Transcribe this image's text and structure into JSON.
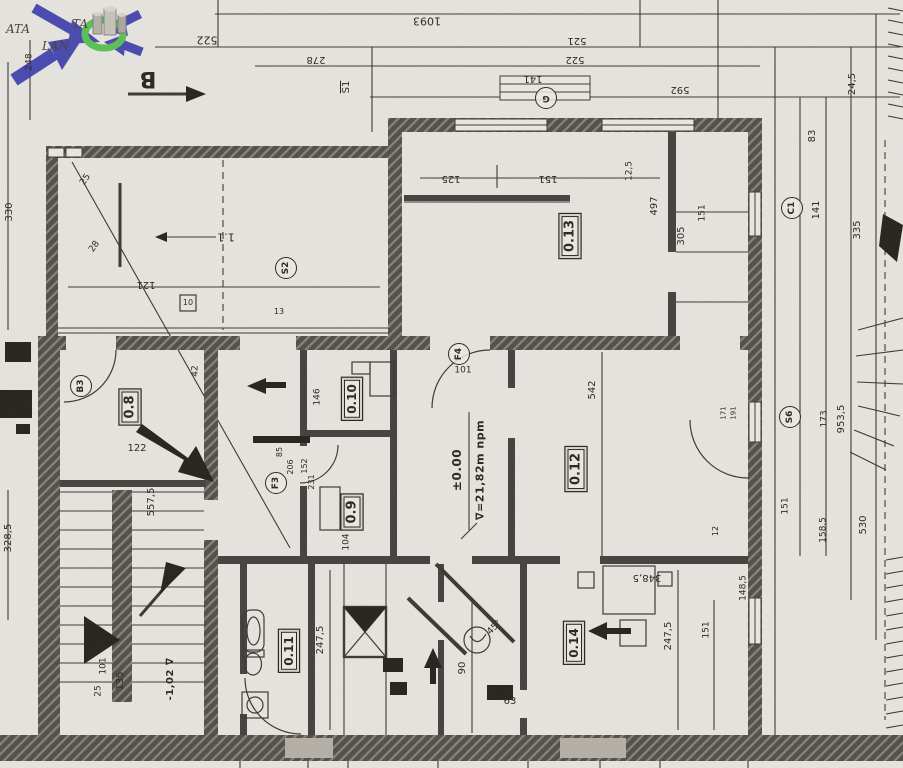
{
  "document": {
    "type": "scanned-floor-plan",
    "sheet": "ground-floor"
  },
  "colors": {
    "paper": "#e9e7e2",
    "ink": "#3c3934",
    "wall": "#514d47",
    "watermark_arrow": "#3d3dae",
    "watermark_ring": "#4fc14a"
  },
  "watermark": {
    "text_ata": "ATA",
    "text_ta": "TA",
    "text_lan": "LAN"
  },
  "levels": {
    "zero": "±0.00",
    "sea": "∇=21,82m npm",
    "minus": "-1,02 ∇"
  },
  "rooms": [
    "0.8",
    "0.9",
    "0.10",
    "0.11",
    "0.12",
    "0.13",
    "0.14",
    "1.1"
  ],
  "annotations": [
    {
      "n": "dim-1093",
      "t": "1093",
      "x": 427,
      "y": 21,
      "r": 180,
      "fs": 11
    },
    {
      "n": "dim-522-left",
      "t": "522",
      "x": 207,
      "y": 40,
      "r": 180,
      "fs": 11
    },
    {
      "n": "dim-278",
      "t": "278",
      "x": 316,
      "y": 59,
      "r": 180,
      "fs": 10
    },
    {
      "n": "dim-521",
      "t": "521",
      "x": 577,
      "y": 40,
      "r": 180,
      "fs": 10
    },
    {
      "n": "dim-522-mid",
      "t": "522",
      "x": 575,
      "y": 59,
      "r": 180,
      "fs": 10
    },
    {
      "n": "dim-141-top",
      "t": "141",
      "x": 533,
      "y": 78,
      "r": 180,
      "fs": 10
    },
    {
      "n": "dim-592",
      "t": "592",
      "x": 680,
      "y": 89,
      "r": 180,
      "fs": 10
    },
    {
      "n": "section-marker-b",
      "t": "B",
      "x": 148,
      "y": 78,
      "r": 180,
      "fs": 22,
      "cls": "sec"
    },
    {
      "n": "stair-label-s1",
      "t": "S1",
      "x": 347,
      "y": 87,
      "r": -90,
      "fs": 10,
      "cls": "ovl"
    },
    {
      "n": "dim-248",
      "t": "248",
      "x": 30,
      "y": 62,
      "r": -90,
      "fs": 9
    },
    {
      "n": "dim-330",
      "t": "330",
      "x": 10,
      "y": 212,
      "r": -90,
      "fs": 10
    },
    {
      "n": "dim-24-5",
      "t": "24,5",
      "x": 853,
      "y": 84,
      "r": -90,
      "fs": 10
    },
    {
      "n": "dim-83",
      "t": "83",
      "x": 813,
      "y": 136,
      "r": -90,
      "fs": 10
    },
    {
      "n": "dim-141-right",
      "t": "141",
      "x": 817,
      "y": 210,
      "r": -90,
      "fs": 10
    },
    {
      "n": "dim-335",
      "t": "335",
      "x": 858,
      "y": 230,
      "r": -90,
      "fs": 10
    },
    {
      "n": "dim-12-5",
      "t": "12,5",
      "x": 630,
      "y": 171,
      "r": -90,
      "fs": 9
    },
    {
      "n": "dim-125",
      "t": "125",
      "x": 451,
      "y": 178,
      "r": 180,
      "fs": 10
    },
    {
      "n": "dim-151-top",
      "t": "151",
      "x": 548,
      "y": 178,
      "r": 180,
      "fs": 10
    },
    {
      "n": "dim-497",
      "t": "497",
      "x": 655,
      "y": 206,
      "r": -90,
      "fs": 10
    },
    {
      "n": "dim-305",
      "t": "305",
      "x": 682,
      "y": 236,
      "r": -90,
      "fs": 10
    },
    {
      "n": "dim-151-corridor",
      "t": "151",
      "x": 703,
      "y": 213,
      "r": -90,
      "fs": 9
    },
    {
      "n": "room-label-0-13",
      "t": "0.13",
      "x": 570,
      "y": 236,
      "r": -90,
      "fs": 13,
      "cls": "box"
    },
    {
      "n": "label-1-1",
      "t": "1.1",
      "x": 226,
      "y": 237,
      "r": 180,
      "fs": 11
    },
    {
      "n": "dim-121",
      "t": "121",
      "x": 146,
      "y": 284,
      "r": 180,
      "fs": 10
    },
    {
      "n": "dim-25-terrace",
      "t": "25",
      "x": 86,
      "y": 180,
      "r": -55,
      "fs": 9
    },
    {
      "n": "dim-28-terrace",
      "t": "28",
      "x": 95,
      "y": 247,
      "r": -55,
      "fs": 9
    },
    {
      "n": "marker-s2",
      "t": "S2",
      "x": 286,
      "y": 268,
      "r": -90,
      "fs": 9,
      "cls": "circ"
    },
    {
      "n": "label-10",
      "t": "10",
      "x": 188,
      "y": 303,
      "r": 0,
      "fs": 8
    },
    {
      "n": "label-13",
      "t": "13",
      "x": 279,
      "y": 312,
      "r": 0,
      "fs": 8
    },
    {
      "n": "marker-b3",
      "t": "B3",
      "x": 81,
      "y": 386,
      "r": -90,
      "fs": 9,
      "cls": "circ"
    },
    {
      "n": "room-label-0-8",
      "t": "0.8",
      "x": 130,
      "y": 407,
      "r": -90,
      "fs": 13,
      "cls": "box"
    },
    {
      "n": "dim-42",
      "t": "42",
      "x": 196,
      "y": 371,
      "r": -90,
      "fs": 9
    },
    {
      "n": "dim-122",
      "t": "122",
      "x": 137,
      "y": 449,
      "r": 0,
      "fs": 10
    },
    {
      "n": "marker-g",
      "t": "G",
      "x": 546,
      "y": 98,
      "r": 180,
      "fs": 9,
      "cls": "circ"
    },
    {
      "n": "marker-c1",
      "t": "C1",
      "x": 792,
      "y": 208,
      "r": -90,
      "fs": 9,
      "cls": "circ"
    },
    {
      "n": "marker-s6",
      "t": "S6",
      "x": 790,
      "y": 417,
      "r": -90,
      "fs": 9,
      "cls": "circ"
    },
    {
      "n": "marker-f4",
      "t": "F4",
      "x": 459,
      "y": 354,
      "r": -90,
      "fs": 9,
      "cls": "circ"
    },
    {
      "n": "marker-f3",
      "t": "F3",
      "x": 276,
      "y": 483,
      "r": -90,
      "fs": 9,
      "cls": "circ"
    },
    {
      "n": "dim-101-hall",
      "t": "101",
      "x": 463,
      "y": 371,
      "r": 0,
      "fs": 9
    },
    {
      "n": "room-label-0-10",
      "t": "0.10",
      "x": 352,
      "y": 399,
      "r": -90,
      "fs": 12,
      "cls": "box"
    },
    {
      "n": "room-label-0-9",
      "t": "0.9",
      "x": 352,
      "y": 512,
      "r": -90,
      "fs": 13,
      "cls": "box"
    },
    {
      "n": "dim-146",
      "t": "146",
      "x": 318,
      "y": 397,
      "r": -90,
      "fs": 9
    },
    {
      "n": "dim-85",
      "t": "85",
      "x": 280,
      "y": 452,
      "r": -90,
      "fs": 8
    },
    {
      "n": "dim-206",
      "t": "206",
      "x": 291,
      "y": 467,
      "r": -90,
      "fs": 8
    },
    {
      "n": "dim-152",
      "t": "152",
      "x": 305,
      "y": 466,
      "r": -90,
      "fs": 8
    },
    {
      "n": "dim-231",
      "t": "231",
      "x": 312,
      "y": 482,
      "r": -90,
      "fs": 8
    },
    {
      "n": "dim-104",
      "t": "104",
      "x": 347,
      "y": 542,
      "r": -90,
      "fs": 9
    },
    {
      "n": "level-zero",
      "t": "±0.00",
      "x": 457,
      "y": 470,
      "r": -90,
      "fs": 12,
      "cls": "lvl"
    },
    {
      "n": "level-sea",
      "t": "∇=21,82m npm",
      "x": 480,
      "y": 470,
      "r": -90,
      "fs": 11,
      "cls": "lvl"
    },
    {
      "n": "room-label-0-12",
      "t": "0.12",
      "x": 576,
      "y": 469,
      "r": -90,
      "fs": 13,
      "cls": "box"
    },
    {
      "n": "dim-542",
      "t": "542",
      "x": 593,
      "y": 390,
      "r": -90,
      "fs": 10
    },
    {
      "n": "dim-557-5",
      "t": "557,5",
      "x": 152,
      "y": 502,
      "r": -90,
      "fs": 10
    },
    {
      "n": "dim-328-5",
      "t": "328,5",
      "x": 9,
      "y": 538,
      "r": -90,
      "fs": 10
    },
    {
      "n": "dim-135",
      "t": "135",
      "x": 121,
      "y": 681,
      "r": -90,
      "fs": 10
    },
    {
      "n": "dim-25-stairs",
      "t": "25",
      "x": 99,
      "y": 691,
      "r": -90,
      "fs": 9
    },
    {
      "n": "dim-101-stairs",
      "t": "101",
      "x": 104,
      "y": 666,
      "r": -90,
      "fs": 9
    },
    {
      "n": "level-minus",
      "t": "-1,02 ∇",
      "x": 171,
      "y": 679,
      "r": -90,
      "fs": 10,
      "cls": "lvl"
    },
    {
      "n": "room-label-0-11",
      "t": "0.11",
      "x": 289,
      "y": 651,
      "r": -90,
      "fs": 12,
      "cls": "box"
    },
    {
      "n": "dim-247-5-left",
      "t": "247,5",
      "x": 321,
      "y": 640,
      "r": -90,
      "fs": 10
    },
    {
      "n": "dim-90",
      "t": "90",
      "x": 463,
      "y": 668,
      "r": -90,
      "fs": 10
    },
    {
      "n": "dim-45deg",
      "t": "45°",
      "x": 495,
      "y": 628,
      "r": -45,
      "fs": 9
    },
    {
      "n": "dim-63",
      "t": "63",
      "x": 510,
      "y": 702,
      "r": 0,
      "fs": 10
    },
    {
      "n": "room-label-0-14",
      "t": "0.14",
      "x": 574,
      "y": 643,
      "r": -90,
      "fs": 12,
      "cls": "box"
    },
    {
      "n": "dim-348-5",
      "t": "348,5",
      "x": 647,
      "y": 577,
      "r": 180,
      "fs": 10
    },
    {
      "n": "dim-247-5-right",
      "t": "247,5",
      "x": 669,
      "y": 636,
      "r": -90,
      "fs": 10
    },
    {
      "n": "dim-151-bottom",
      "t": "151",
      "x": 707,
      "y": 630,
      "r": -90,
      "fs": 9
    },
    {
      "n": "dim-148-5",
      "t": "148,5",
      "x": 744,
      "y": 588,
      "r": -90,
      "fs": 9
    },
    {
      "n": "dim-171",
      "t": "171",
      "x": 724,
      "y": 413,
      "r": -90,
      "fs": 7
    },
    {
      "n": "dim-191",
      "t": "191",
      "x": 734,
      "y": 413,
      "r": -90,
      "fs": 7
    },
    {
      "n": "dim-12",
      "t": "12",
      "x": 716,
      "y": 531,
      "r": -90,
      "fs": 8
    },
    {
      "n": "dim-953-5",
      "t": "953,5",
      "x": 842,
      "y": 419,
      "r": -90,
      "fs": 10
    },
    {
      "n": "dim-173",
      "t": "173",
      "x": 825,
      "y": 419,
      "r": -90,
      "fs": 9
    },
    {
      "n": "dim-151-right",
      "t": "151",
      "x": 786,
      "y": 506,
      "r": -90,
      "fs": 9
    },
    {
      "n": "dim-158-5",
      "t": "158,5",
      "x": 824,
      "y": 530,
      "r": -90,
      "fs": 9
    },
    {
      "n": "dim-530",
      "t": "530",
      "x": 864,
      "y": 525,
      "r": -90,
      "fs": 10
    }
  ]
}
